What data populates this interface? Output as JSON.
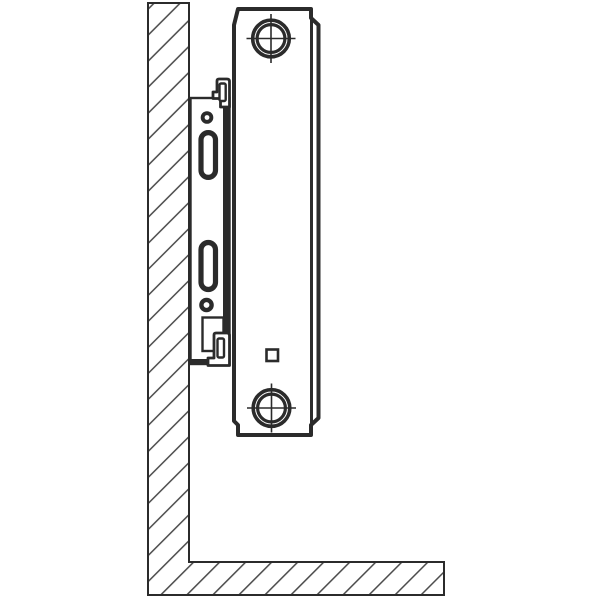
{
  "meta": {
    "title": "Panel radiator wall-mounting bracket — side view technical drawing",
    "description": "Black-and-white line drawing: side cross-section of a steel panel radiator hung on a wall bracket. The wall (left) and floor (bottom) are shown as an L-shaped strip with diagonal section hatching. The bracket plate is fixed to the wall and has two fixing holes and two vertical adjustment slots; top and bottom retaining clips grip the radiator rear panel. The radiator end face shows a top hub and bottom hub (concentric circles with center-line crosshairs) and a small square vent plug near the bottom."
  },
  "colors": {
    "background": "#ffffff",
    "line": "#2b2b2b",
    "hatch": "#4a4a4a",
    "surface": "#ffffff"
  },
  "parts": [
    {
      "id": "wall",
      "label": "wall (hatched section)"
    },
    {
      "id": "floor",
      "label": "floor (hatched section)"
    },
    {
      "id": "bracket-plate",
      "label": "mounting bracket plate"
    },
    {
      "id": "bracket-flange",
      "label": "bracket front flange"
    },
    {
      "id": "top-clip",
      "label": "top retaining clip"
    },
    {
      "id": "bottom-clip",
      "label": "bottom retaining clip"
    },
    {
      "id": "upper-fixing-hole",
      "label": "upper fixing hole"
    },
    {
      "id": "lower-fixing-hole",
      "label": "lower fixing hole"
    },
    {
      "id": "upper-slot",
      "label": "upper adjustment slot"
    },
    {
      "id": "lower-slot",
      "label": "lower adjustment slot"
    },
    {
      "id": "radiator-body",
      "label": "panel radiator, side profile"
    },
    {
      "id": "top-hub",
      "label": "top connection hub with center lines"
    },
    {
      "id": "bottom-hub",
      "label": "bottom connection hub with center lines"
    },
    {
      "id": "vent-plug",
      "label": "square vent plug detail"
    }
  ]
}
